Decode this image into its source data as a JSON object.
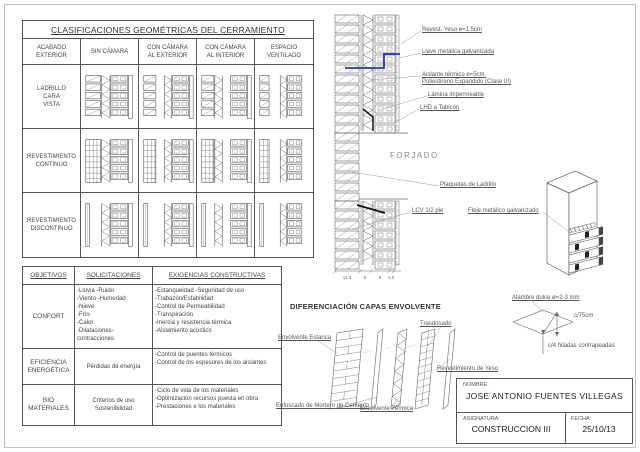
{
  "colors": {
    "accent_blue": "#2233bb",
    "line": "#666666"
  },
  "classification_table": {
    "title": "CLASIFICACIONES GEOMÉTRICAS DEL CERRAMIENTO",
    "col_headers": [
      "ACABADO\nEXTERIOR",
      "SIN CÁMARA",
      "CON CÁMARA\nAL EXTERIOR",
      "CON CÁMARA\nAL INTERIOR",
      "ESPACIO\nVENTILADO"
    ],
    "row_labels": [
      "LADRILLO\nCARA\nVISTA",
      "REVESTIMIENTO\nCONTINUO",
      "REVESTIMIENTO\nDISCONTINUO"
    ]
  },
  "objectives_table": {
    "headers": [
      "OBJETIVOS",
      "SOLICITACIONES",
      "EXIGENCIAS CONSTRUCTIVAS"
    ],
    "rows": [
      {
        "objective": "CONFORT",
        "solicitations": [
          "-Lluvia  -Ruido",
          "-Viento  -Humedad",
          "-Nieve",
          "-Frío",
          "-Calor",
          "-Dilataciones-contracciones"
        ],
        "requirements": [
          "-Estanqueidad  -Seguridad de uso",
          "-Trabazón/Estabilidad",
          "-Control de Permeabilidad",
          "-Transpiración",
          "-Inercia y resistencia térmica",
          "-Aislamiento acústico"
        ]
      },
      {
        "objective": "EFICIENCIA\nENERGÉTICA",
        "solicitations": [
          "Pérdidas de energía"
        ],
        "requirements": [
          "-Control de puentes térmicos",
          "-Control de los espesores de los aislantes"
        ]
      },
      {
        "objective": "BIO\nMATERIALES",
        "solicitations": [
          "Criterios de uso",
          "Sostenibilidad"
        ],
        "requirements": [
          "-Ciclo de vida de los materiales",
          "-Optimización recursos puesta en obra",
          "-Prestaciones e los materiales"
        ]
      }
    ]
  },
  "wall_detail": {
    "callouts": {
      "yeso": "Revest. Yeso e=1.5cm",
      "llave": "Llave metálica galvanizada",
      "aislante": [
        "Aislante térmico  e=5cm.",
        "Poliestireno Expandido (Clase III)"
      ],
      "lamina": "Lámina impermeable",
      "lhd": "LHD a Tabicón",
      "plaquetas": "Plaquetas de Ladrillo",
      "lcv": "LCV 1/2 pie"
    },
    "forjado": "FORJADO",
    "dimensions": [
      "11.4",
      "5",
      "8",
      "1.5"
    ]
  },
  "pillar_detail": {
    "callout": "Fleje metálico galvanizado"
  },
  "wire_detail": {
    "title": "Alambre dulce  ø=2-3 mm",
    "spacing": "c/75cm",
    "note": "c/4 hiladas contrapeadas"
  },
  "envelope_diagram": {
    "title": "DIFERENCIACIÓN CAPAS ENVOLVENTE",
    "labels": {
      "estanca": "Envolvente Estanca",
      "trasdosado": "Trasdosado",
      "yeso": "Revestimiento de Yeso",
      "enfoscado": "Enfoscado de Mortero de Cemento",
      "termica": "Envolvente Térmica"
    }
  },
  "title_block": {
    "name_label": "NOMBRE:",
    "name": "JOSE ANTONIO FUENTES VILLEGAS",
    "subject_label": "ASIGNATURA:",
    "subject": "CONSTRUCCION III",
    "date_label": "FECHA:",
    "date": "25/10/13"
  }
}
